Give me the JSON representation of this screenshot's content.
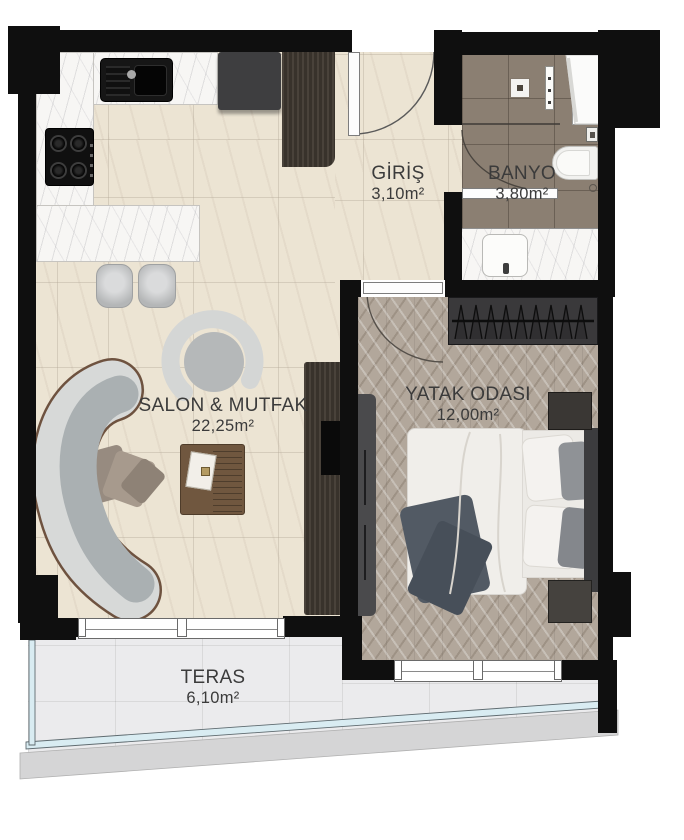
{
  "plan": {
    "rooms": [
      {
        "key": "giris",
        "name": "GİRİŞ",
        "area": "3,10m²"
      },
      {
        "key": "banyo",
        "name": "BANYO",
        "area": "3,80m²"
      },
      {
        "key": "salon_mutfak",
        "name": "SALON & MUTFAK",
        "area": "22,25m²"
      },
      {
        "key": "yatak_odasi",
        "name": "YATAK ODASI",
        "area": "12,00m²"
      },
      {
        "key": "teras",
        "name": "TERAS",
        "area": "6,10m²"
      }
    ]
  },
  "colors": {
    "wall": "#0f0f0f",
    "floor_cream": "#ece4d3",
    "kitchen_marble": "#f7f6f4",
    "bath_tile": "#8b7f72",
    "wood_floor": "#b2a79b",
    "terrace_floor": "#ebebed",
    "terrace_glass": "#d9ecf2",
    "slab": "#d5d5d6",
    "label_text": "#3b3b3b",
    "sofa_gray": "#aab0b2",
    "sofa_rim": "#d7d9d8",
    "sofa_trim": "#6e523f",
    "furniture_wood_dark": "#3f3933",
    "wardrobe_dark": "#3a393b",
    "bed_white": "#f0eeea",
    "throw_dark": "#525a64"
  }
}
